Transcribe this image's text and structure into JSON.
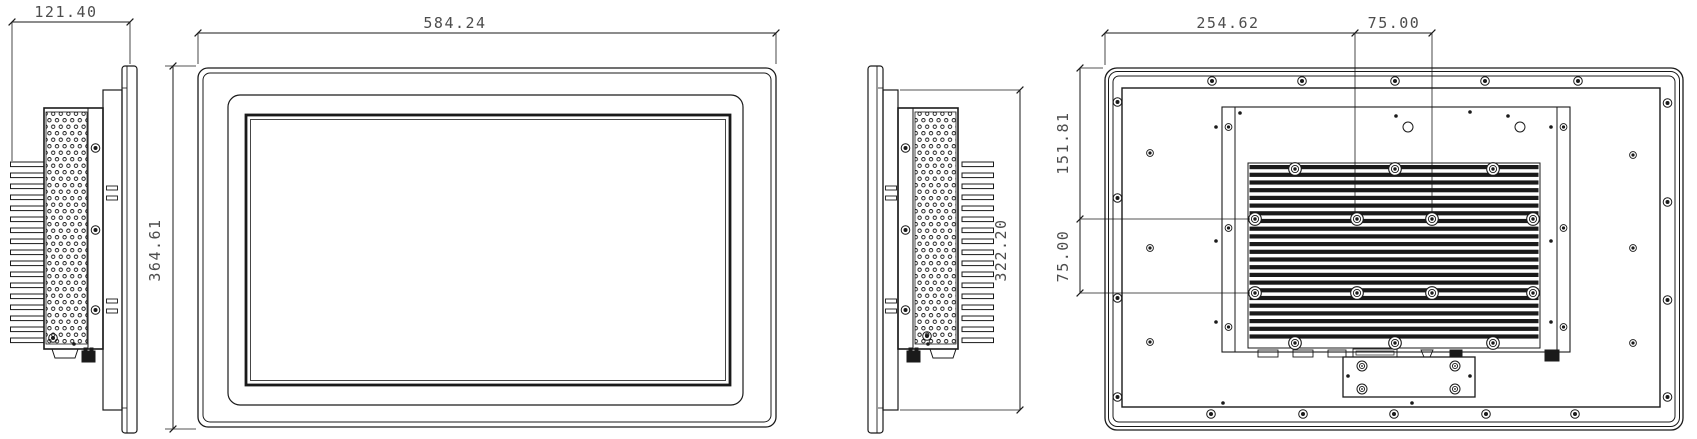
{
  "colors": {
    "background": "#ffffff",
    "line": "#1a1a1a",
    "dim_text": "#4d4d4d"
  },
  "views": {
    "side_left": {
      "dims": {
        "width": "121.40"
      }
    },
    "front": {
      "dims": {
        "width": "584.24",
        "height": "364.61"
      }
    },
    "side_right": {
      "dims": {
        "height": "322.20"
      }
    },
    "rear": {
      "dims": {
        "top_left": "254.62",
        "top_right": "75.00",
        "left_top": "151.81",
        "left_bottom": "75.00"
      }
    }
  }
}
